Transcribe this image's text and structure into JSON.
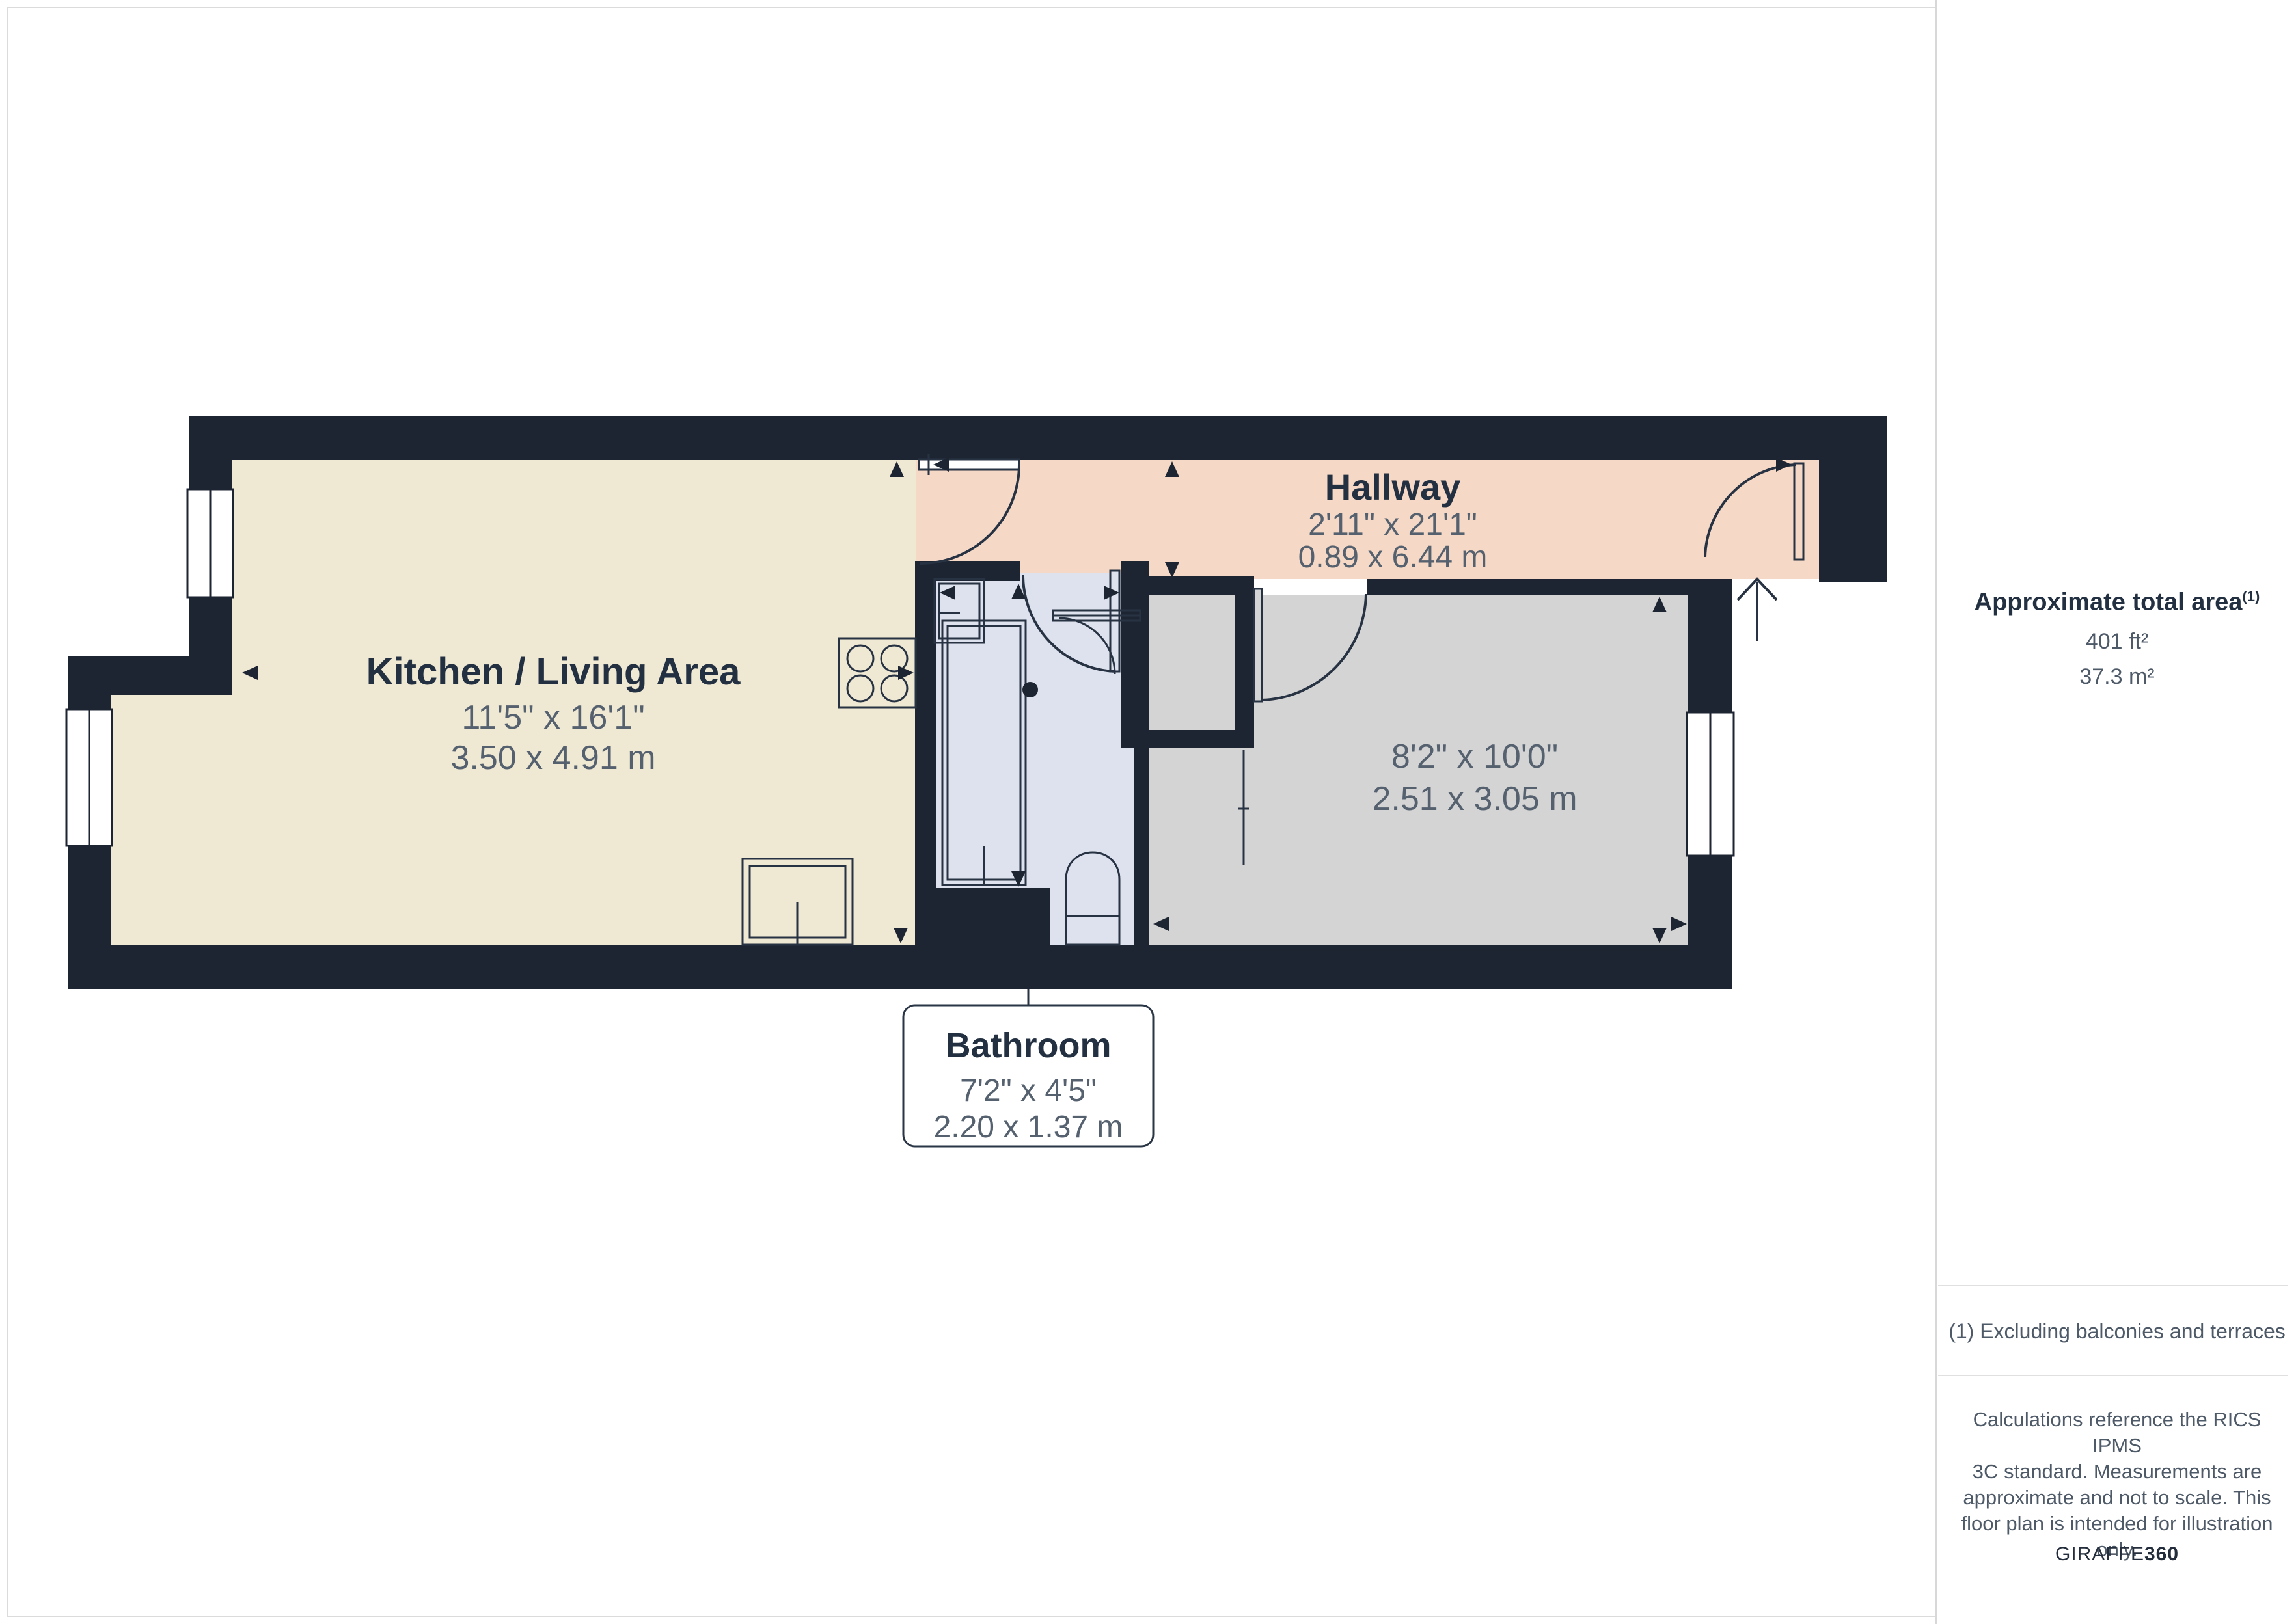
{
  "page": {
    "background": "#ffffff",
    "border_color": "#DBDBDB"
  },
  "floorplan": {
    "wall_color": "#1E2532",
    "rooms": [
      {
        "id": "kitchen-living",
        "name": "Kitchen / Living Area",
        "dims_imperial": "11'5\" x 16'1\"",
        "dims_metric": "3.50 x 4.91 m",
        "color": "#EFE8D3"
      },
      {
        "id": "hallway",
        "name": "Hallway",
        "dims_imperial": "2'11\" x 21'1\"",
        "dims_metric": "0.89 x 6.44 m",
        "color": "#F5D8C5"
      },
      {
        "id": "bathroom",
        "name": "Bathroom",
        "dims_imperial": "7'2\" x 4'5\"",
        "dims_metric": "2.20 x 1.37 m",
        "color": "#DDE2EE"
      },
      {
        "id": "room",
        "name": "",
        "dims_imperial": "8'2\" x 10'0\"",
        "dims_metric": "2.51 x 3.05 m",
        "color": "#D4D4D4"
      }
    ]
  },
  "sidebar": {
    "area_title": "Approximate total area",
    "area_title_sup": "(1)",
    "area_ft": "401 ft²",
    "area_m": "37.3 m²",
    "footnote": "(1) Excluding balconies and terraces",
    "disclaimer_lines": [
      "Calculations reference the RICS IPMS",
      "3C standard. Measurements are",
      "approximate and not to scale. This",
      "floor plan is intended for illustration",
      "only."
    ],
    "logo_primary": "GIRAFFE",
    "logo_secondary": "360"
  }
}
